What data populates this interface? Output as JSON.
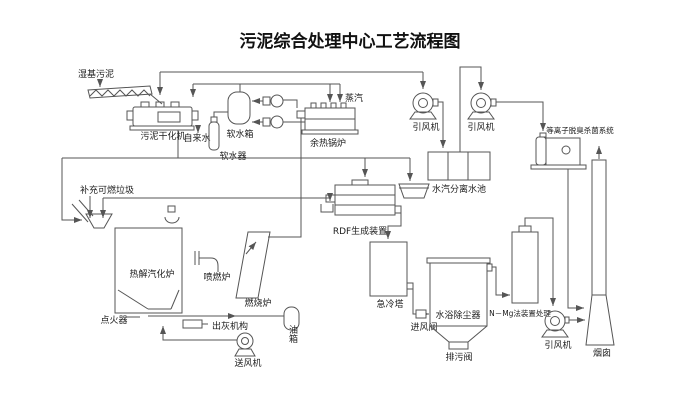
{
  "title": "污泥综合处理中心工艺流程图",
  "colors": {
    "line": "#555555",
    "text": "#1c1c1c",
    "background": "#ffffff"
  },
  "labels": {
    "wet_sludge": "湿基污泥",
    "sludge_dryer": "污泥干化机",
    "tap_water": "自来水",
    "soft_water_tank": "软水箱",
    "water_softener": "软水器",
    "steam": "蒸汽",
    "waste_heat_boiler": "余热锅炉",
    "induced_fan_1": "引风机",
    "induced_fan_2": "引风机",
    "plasma_deodorize_system": "等离子脱臭杀菌系统",
    "steam_water_separation_pool": "水汽分离水池",
    "supplement_combustible_waste": "补充可燃垃圾",
    "rdf_device": "RDF生成装置",
    "pyrolysis_gasifier": "热解汽化炉",
    "spray_burner": "喷燃炉",
    "combustion_furnace": "燃烧炉",
    "igniter": "点火器",
    "ash_discharge": "出灰机构",
    "forced_draft_fan": "送风机",
    "oil_tank": "油箱",
    "quench_tower": "急冷塔",
    "air_inlet_valve": "进风阀",
    "water_bath_dust_collector": "水浴除尘器",
    "drain_valve": "排污阀",
    "n_mg_treatment": "N－Mg法装置处理",
    "induced_fan_3": "引风机",
    "chimney": "烟囱"
  }
}
